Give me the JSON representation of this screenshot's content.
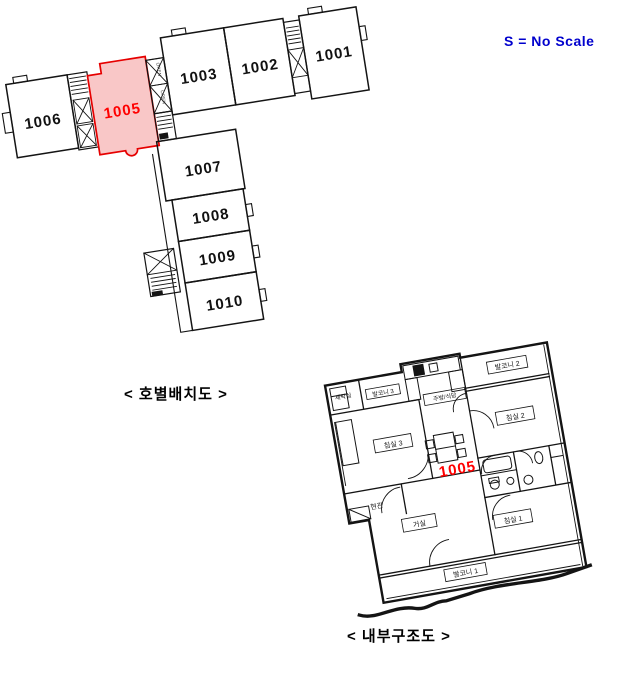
{
  "scale_note": {
    "label": "S = No Scale",
    "color": "#0000cd"
  },
  "captions": {
    "building_layout": "< 호별배치도 >",
    "interior_layout": "< 내부구조도 >"
  },
  "colors": {
    "wall": "#141414",
    "background": "#ffffff"
  },
  "building_plan": {
    "description": "apartment floor unit-arrangement plan",
    "core_label": "OPEN",
    "highlight": {
      "unit": "1005",
      "fill": "#f9c7c7",
      "stroke": "#e60000",
      "text_color": "#ff0000"
    },
    "units": [
      {
        "id": "1001",
        "label": "1001"
      },
      {
        "id": "1002",
        "label": "1002"
      },
      {
        "id": "1003",
        "label": "1003"
      },
      {
        "id": "1005",
        "label": "1005",
        "highlighted": true
      },
      {
        "id": "1006",
        "label": "1006"
      },
      {
        "id": "1007",
        "label": "1007"
      },
      {
        "id": "1008",
        "label": "1008"
      },
      {
        "id": "1009",
        "label": "1009"
      },
      {
        "id": "1010",
        "label": "1010"
      }
    ]
  },
  "interior_plan": {
    "unit_label": "1005",
    "unit_label_color": "#ff0000",
    "rooms": [
      {
        "id": "laundry",
        "label": "세탁실"
      },
      {
        "id": "balcony-3",
        "label": "발코니 3"
      },
      {
        "id": "kitchen-dining",
        "label": "주방/식당"
      },
      {
        "id": "balcony-2",
        "label": "발코니 2"
      },
      {
        "id": "bedroom-2",
        "label": "침실 2"
      },
      {
        "id": "bedroom-3",
        "label": "침실 3"
      },
      {
        "id": "entrance",
        "label": "현관"
      },
      {
        "id": "living-room",
        "label": "거실"
      },
      {
        "id": "bedroom-1",
        "label": "침실 1"
      },
      {
        "id": "balcony-1",
        "label": "발코니 1"
      }
    ]
  }
}
